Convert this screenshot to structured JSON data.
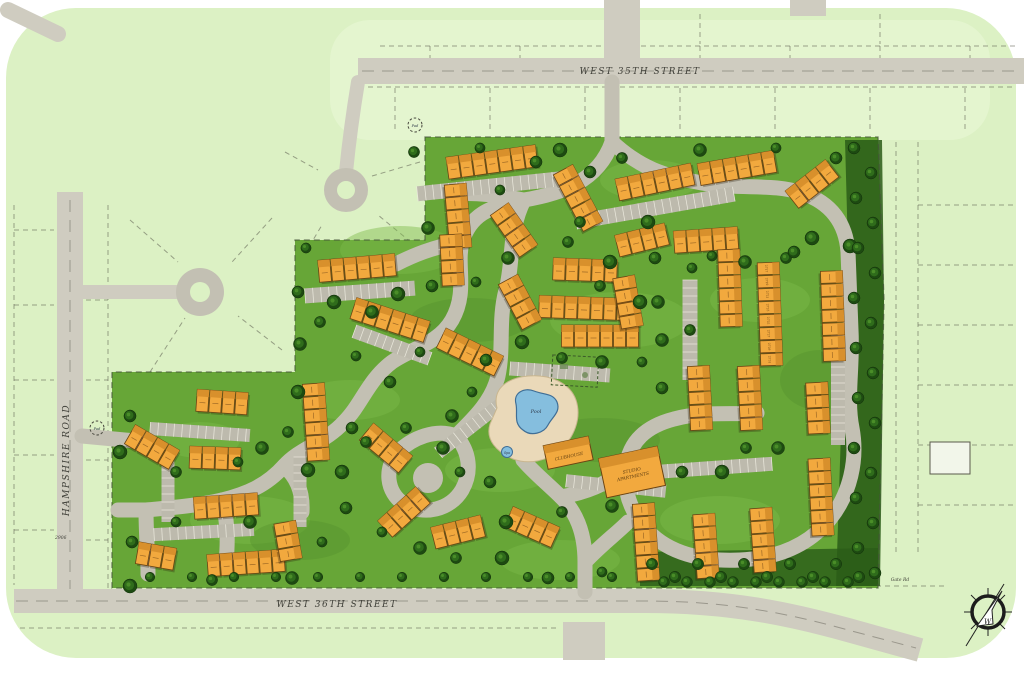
{
  "streets": {
    "north": "WEST 35TH STREET",
    "south": "WEST 36TH STREET",
    "west": "HAMPSHIRE ROAD"
  },
  "amenities": {
    "pool": "Pool",
    "spa": "Spa",
    "clubhouse": "CLUBHOUSE",
    "studio_line1": "STUDIO",
    "studio_line2": "APARTMENTS"
  },
  "markers": {
    "pad": "Pad",
    "gate": "Gate Rd",
    "parcel_number": "2906",
    "compass_letter": "W"
  },
  "unit_numbers": [
    "2717",
    "2719",
    "2721",
    "2723",
    "2725",
    "2727",
    "2729",
    "2731"
  ],
  "colors": {
    "page_bg": "#ffffff",
    "parcel_green": "#dcf1c4",
    "parcel_green_light": "#e6f6d2",
    "lawn_green": "#67a637",
    "lawn_light": "#7cba4a",
    "lawn_dark": "#55922c",
    "street_gray": "#cfccc0",
    "road_gray": "#c3c0b3",
    "parking_gray": "#bdbaad",
    "stall_line": "#eceade",
    "tree_dark": "#1d4a11",
    "tree_mid": "#2f6c1b",
    "tree_light": "#4a8d28",
    "forest": "#2a5c18",
    "building_orange": "#f2a93e",
    "building_roof": "#d8902c",
    "building_outline": "#6b4413",
    "deck_tan": "#ead9b9",
    "pool_blue": "#85bede",
    "pool_edge": "#3f6e96",
    "label_dark": "#3f3f38"
  }
}
